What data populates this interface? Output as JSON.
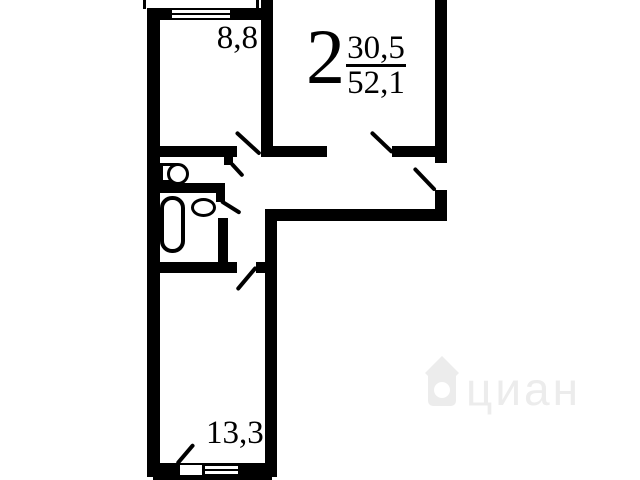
{
  "plan": {
    "title": {
      "rooms_count": "2",
      "value_top": "30,5",
      "value_bottom": "52,1"
    },
    "rooms": [
      {
        "name": "room-top-left",
        "area_label": "8,8"
      },
      {
        "name": "room-bottom-left",
        "area_label": "13,3"
      }
    ],
    "fixtures": [
      "toilet-icon",
      "bathtub-icon",
      "sink-icon"
    ],
    "watermark": {
      "text": "циан",
      "logo": "house-pin-icon"
    },
    "colors": {
      "wall": "#000000",
      "background": "#ffffff",
      "watermark": "#ececec"
    }
  }
}
